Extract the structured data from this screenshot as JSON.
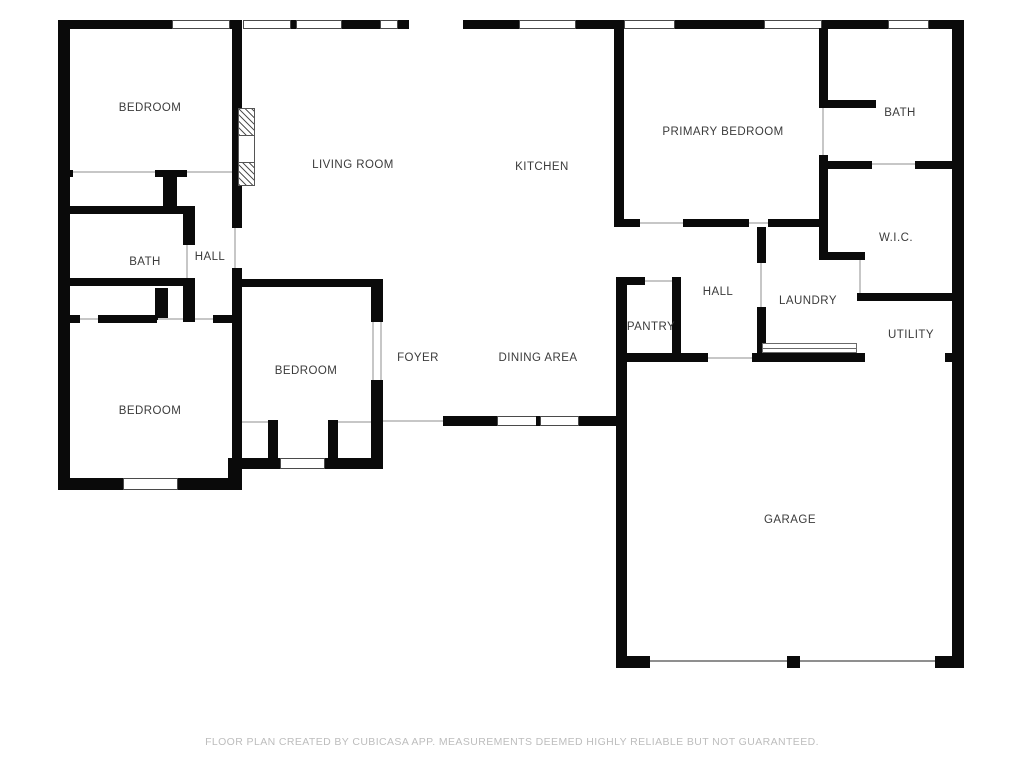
{
  "colors": {
    "wall": "#0a0a0a",
    "label": "#3b3b3b",
    "footer": "#bdbdbd"
  },
  "rooms": [
    {
      "id": "bedroom-top-left",
      "label": "BEDROOM"
    },
    {
      "id": "living-room",
      "label": "LIVING ROOM"
    },
    {
      "id": "kitchen",
      "label": "KITCHEN"
    },
    {
      "id": "primary-bedroom",
      "label": "PRIMARY BEDROOM"
    },
    {
      "id": "bath-primary",
      "label": "BATH"
    },
    {
      "id": "walk-in-closet",
      "label": "W.I.C."
    },
    {
      "id": "hall-right",
      "label": "HALL"
    },
    {
      "id": "laundry",
      "label": "LAUNDRY"
    },
    {
      "id": "utility",
      "label": "UTILITY"
    },
    {
      "id": "pantry",
      "label": "PANTRY"
    },
    {
      "id": "bath-left",
      "label": "BATH"
    },
    {
      "id": "hall-left",
      "label": "HALL"
    },
    {
      "id": "bedroom-middle",
      "label": "BEDROOM"
    },
    {
      "id": "foyer",
      "label": "FOYER"
    },
    {
      "id": "dining-area",
      "label": "DINING AREA"
    },
    {
      "id": "bedroom-bottom-left",
      "label": "BEDROOM"
    },
    {
      "id": "garage",
      "label": "GARAGE"
    }
  ],
  "footer": {
    "disclaimer": "FLOOR PLAN CREATED BY CUBICASA APP. MEASUREMENTS DEEMED HIGHLY RELIABLE BUT NOT GUARANTEED."
  }
}
